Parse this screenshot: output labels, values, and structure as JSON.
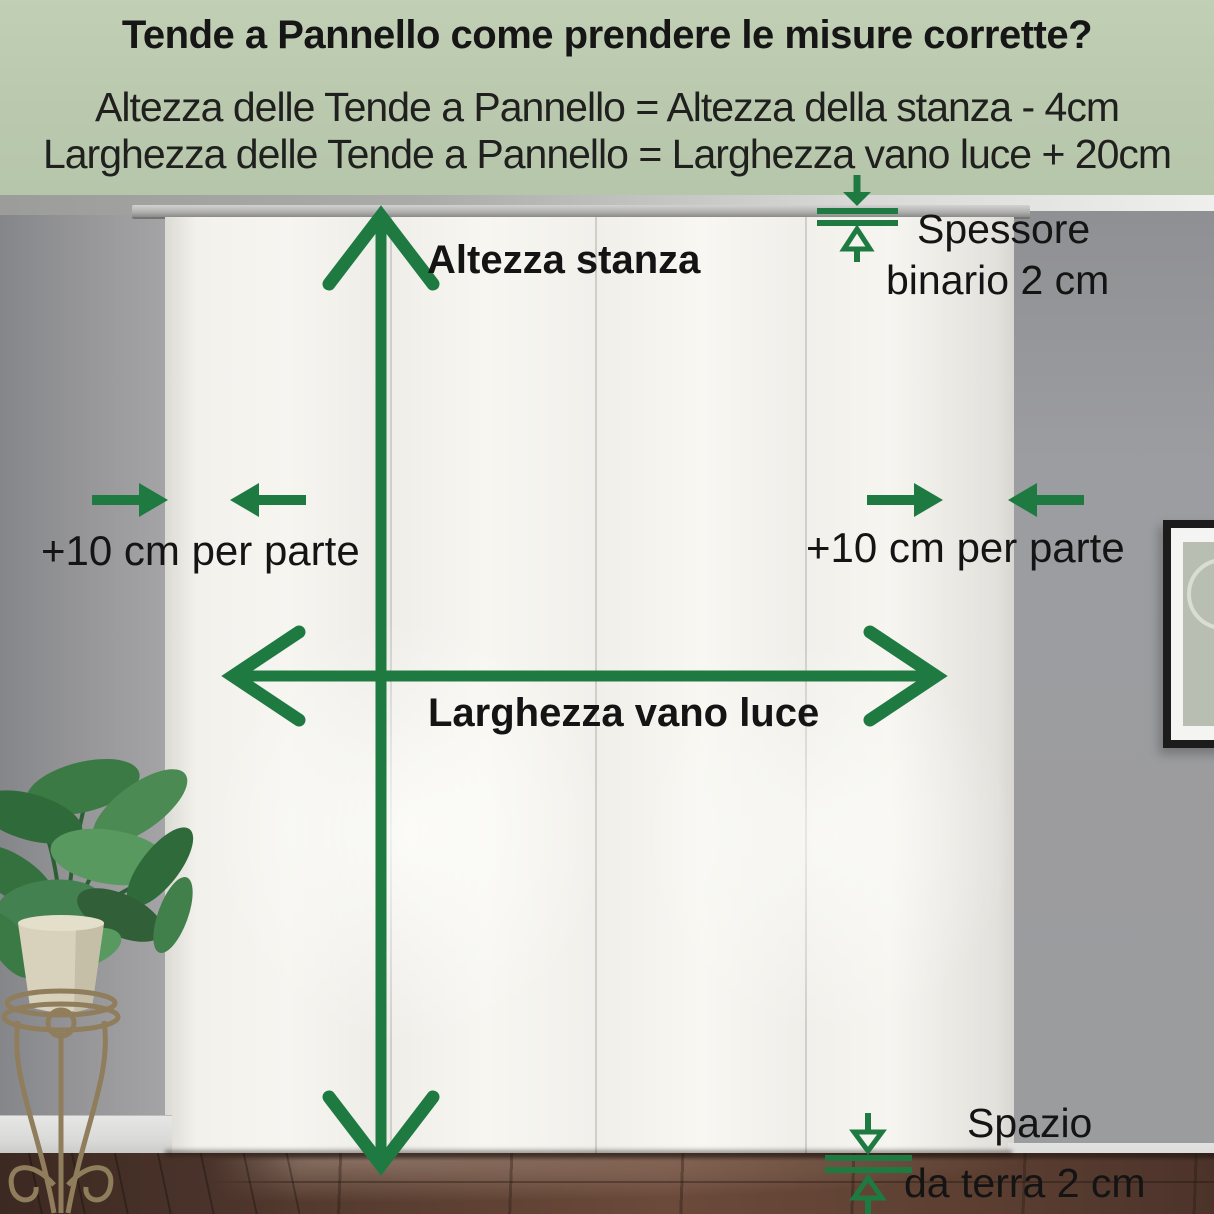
{
  "header": {
    "title": "Tende a Pannello come prendere le misure corrette?",
    "formula_height": "Altezza delle Tende a Pannello = Altezza della stanza - 4cm",
    "formula_width": "Larghezza delle Tende a Pannello = Larghezza vano luce + 20cm"
  },
  "annotations": {
    "room_height": "Altezza stanza",
    "opening_width": "Larghezza vano luce",
    "side_margin_left": "+10 cm per parte",
    "side_margin_right": "+10 cm per parte",
    "rail_thickness_line1": "Spessore",
    "rail_thickness_line2": "binario 2 cm",
    "floor_gap_line1": "Spazio",
    "floor_gap_line2": "da terra 2 cm"
  },
  "colors": {
    "annotation_green": "#1e7a41",
    "header_background": "#bac9ae",
    "label_text": "#141414",
    "curtain_white": "#f3f2ed",
    "wall_grey": "#9b9c9e",
    "floor_brown": "#5c3f31"
  }
}
